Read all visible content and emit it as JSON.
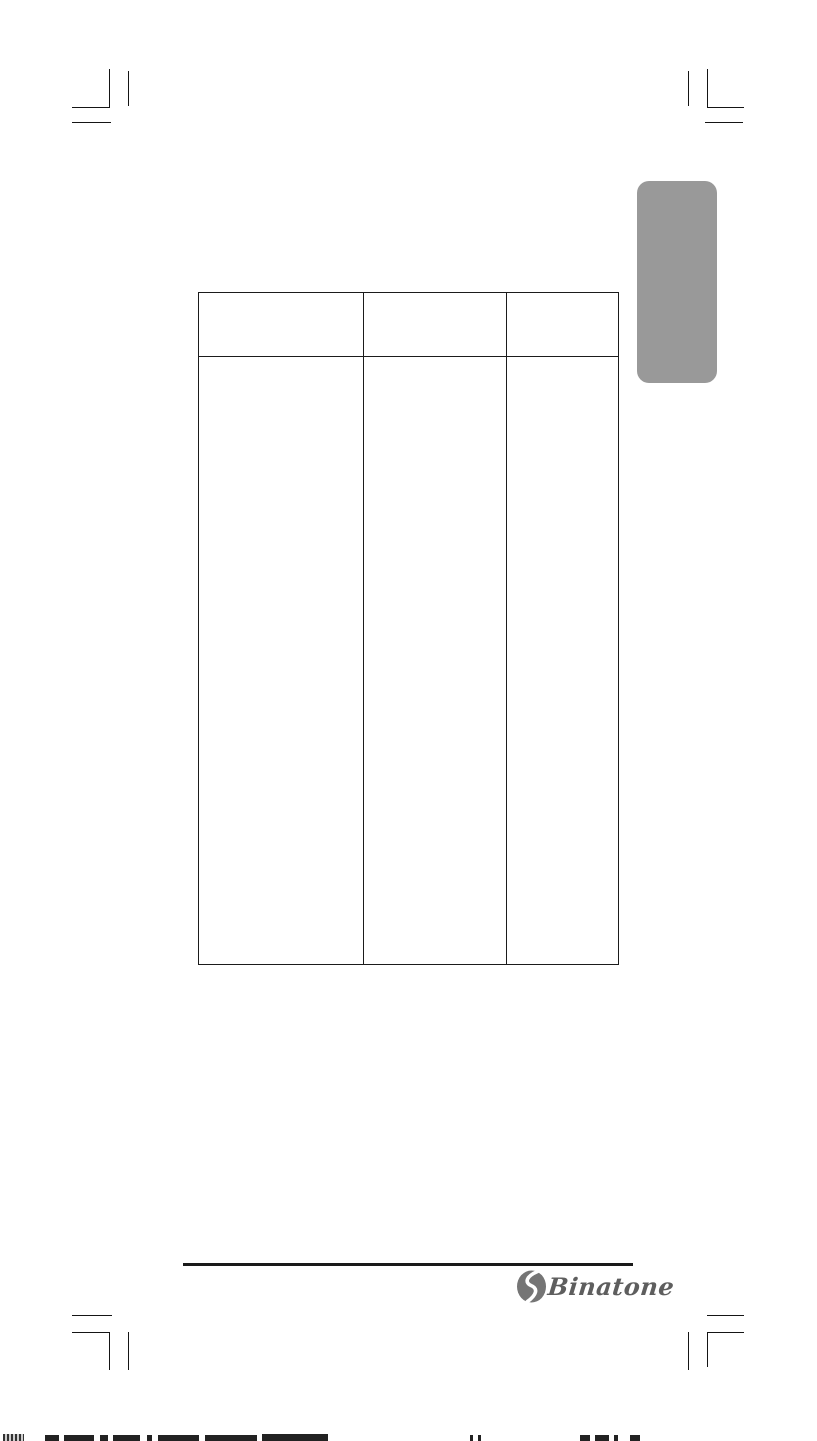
{
  "colors": {
    "page_background": "#ffffff",
    "crop_mark_black": "#151515",
    "tab_gray": "#999999",
    "table_border": "#1b1b1b",
    "footer_rule_black": "#1a1a1a",
    "logo_icon_gray": "#757575",
    "logo_text_gray": "#5e5e5e"
  },
  "table": {
    "header": [
      "",
      "",
      ""
    ],
    "body": [
      "",
      "",
      ""
    ]
  },
  "footer": {
    "brand": "Binatone"
  }
}
